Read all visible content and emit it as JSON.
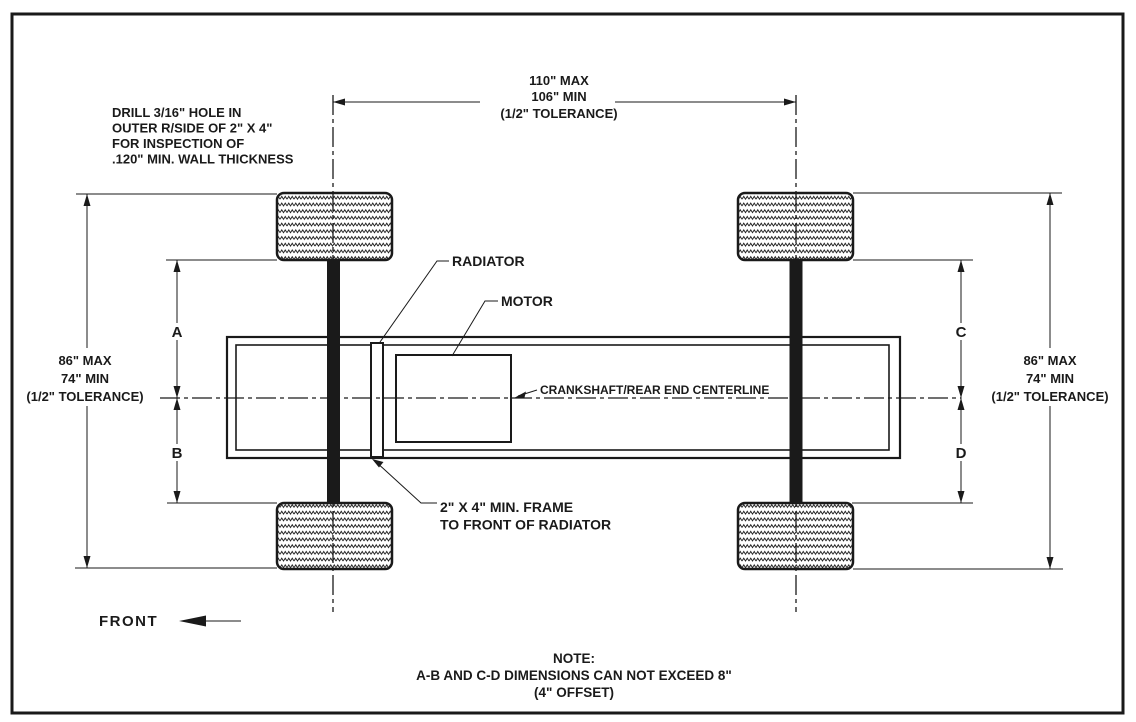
{
  "drill_note": {
    "l1": "DRILL 3/16\" HOLE IN",
    "l2": "OUTER R/SIDE OF 2\" X 4\"",
    "l3": "FOR INSPECTION OF",
    "l4": ".120\" MIN. WALL THICKNESS"
  },
  "dim_wheelbase": {
    "max": "110\" MAX",
    "min": "106\" MIN",
    "tol": "(1/2\" TOLERANCE)"
  },
  "dim_track_left": {
    "max": "86\" MAX",
    "min": "74\" MIN",
    "tol": "(1/2\" TOLERANCE)"
  },
  "dim_track_right": {
    "max": "86\" MAX",
    "min": "74\" MIN",
    "tol": "(1/2\" TOLERANCE)"
  },
  "offsets": {
    "a": "A",
    "b": "B",
    "c": "C",
    "d": "D"
  },
  "labels": {
    "radiator": "RADIATOR",
    "motor": "MOTOR",
    "crankshaft_centerline": "CRANKSHAFT/REAR END CENTERLINE",
    "frame_note_l1": "2\" X 4\" MIN. FRAME",
    "frame_note_l2": "TO FRONT OF RADIATOR",
    "front": "FRONT"
  },
  "bottom_note": {
    "l1": "NOTE:",
    "l2": "A-B AND C-D DIMENSIONS CAN NOT EXCEED 8\"",
    "l3": "(4\" OFFSET)"
  },
  "colors": {
    "ink": "#1a1a1a",
    "paper": "#ffffff"
  }
}
